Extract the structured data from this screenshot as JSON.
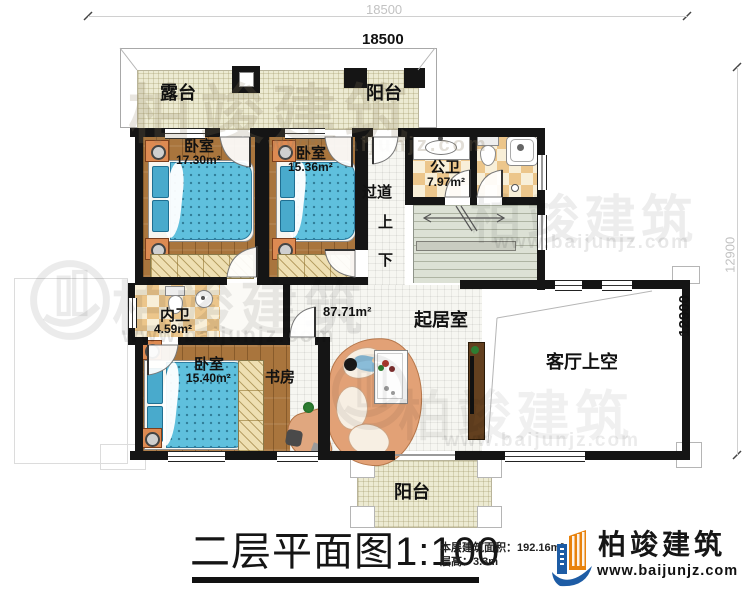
{
  "dimensions": {
    "width_outer": "18500",
    "width_inner": "18500",
    "height_outer": "12900",
    "height_inner": "12900"
  },
  "rooms": {
    "terrace": {
      "label": "露台"
    },
    "balcony_top": {
      "label": "阳台"
    },
    "bedroom1": {
      "label": "卧室",
      "area": "17.30m²"
    },
    "bedroom2": {
      "label": "卧室",
      "area": "15.36m²"
    },
    "corridor": {
      "label": "过道"
    },
    "stairs_up": {
      "label": "上"
    },
    "stairs_down": {
      "label": "下"
    },
    "public_bath": {
      "label": "公卫",
      "area": "7.97m²"
    },
    "inner_bath": {
      "label": "内卫",
      "area": "4.59m²"
    },
    "bedroom3": {
      "label": "卧室",
      "area": "15.40m²"
    },
    "study": {
      "label": "书房"
    },
    "living": {
      "label": "起居室",
      "area": "87.71m²"
    },
    "void": {
      "label": "客厅上空"
    },
    "balcony_bottom": {
      "label": "阳台"
    }
  },
  "title": {
    "text": "二层平面图1:100"
  },
  "info": {
    "area_label": "本层建筑面积：",
    "area_value": "192.16m²",
    "floor_height_label": "层高：",
    "floor_height_value": "3.3m"
  },
  "brand": {
    "name": "柏竣建筑",
    "url": "www.baijunjz.com"
  },
  "watermark": {
    "name": "柏竣建筑",
    "url": "www.baijunjz.com"
  },
  "colors": {
    "wall": "#151515",
    "wood": "#a9753d",
    "bed": "#5fc0dd",
    "tile_tan": "#ecc68b",
    "tile_cream": "#f8efd8",
    "terrace": "#ecead2",
    "stairs": "#dce1d5",
    "sofa": "#e2a176",
    "brand_blue": "#1d5ca5",
    "brand_orange": "#e8820c"
  }
}
